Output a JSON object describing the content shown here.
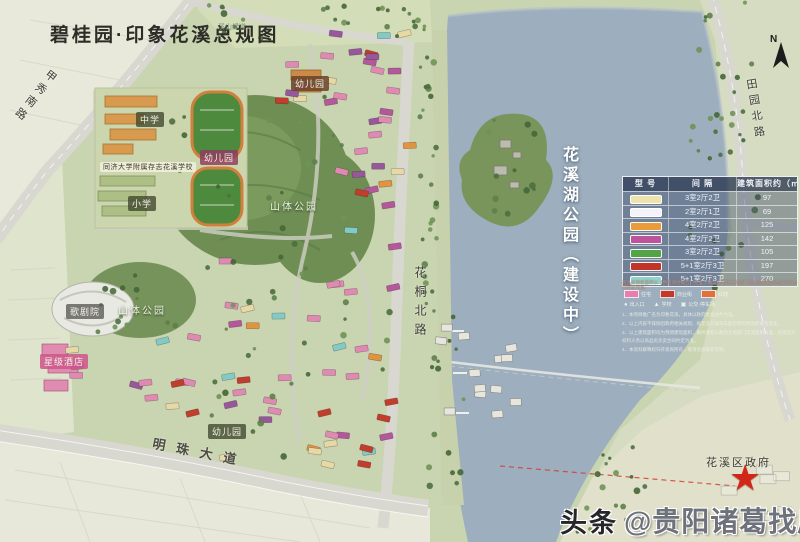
{
  "title": "碧桂园·印象花溪总规图",
  "north_label": "N",
  "map_labels": {
    "jiaxiu_road": "甲秀南路",
    "tianyuan_road": "田园北路",
    "huatong_road": "花桐北路",
    "mingzhu_road": "明珠大道",
    "greenway": "溪山绿道",
    "middle_school": "中学",
    "primary_school": "小学",
    "school_full": "同济大学附属存志花溪学校",
    "kindergarten_top": "幼儿园",
    "kindergarten_mid": "幼儿园",
    "kindergarten_bottom": "幼儿园",
    "mountain_park_main": "山体公园",
    "mountain_park_west": "山体公园",
    "opera_house": "歌剧院",
    "star_hotel": "星级酒店",
    "lake_park": "花溪湖公园（建设中）",
    "district_government": "花溪区政府"
  },
  "legend": {
    "headers": [
      "型 号",
      "间 隔",
      "建筑面积约（㎡）"
    ],
    "rows": [
      {
        "color": "#eee3ac",
        "layout": "3室2厅2卫",
        "area": "97"
      },
      {
        "color": "#f3f3f9",
        "layout": "2室2厅1卫",
        "area": "69"
      },
      {
        "color": "#ea9c3b",
        "layout": "4室2厅2卫",
        "area": "125"
      },
      {
        "color": "#bd539b",
        "layout": "4室2厅2卫",
        "area": "142"
      },
      {
        "color": "#54a447",
        "layout": "3室2厅2卫",
        "area": "105"
      },
      {
        "color": "#c03527",
        "layout": "5+1室2厅3卫",
        "area": "197"
      },
      {
        "color": "#8fd3cd",
        "layout": "5+1室2厅3卫",
        "area": "270"
      }
    ],
    "note": "商品房预售面积以【预售测绘报告】为准，确认以行政主管部门测绘结果和商品房买卖合同约定为准。",
    "mini_chips": [
      {
        "color": "#e77fae",
        "label": "住宅"
      },
      {
        "color": "#c13a28",
        "label": "商业街"
      },
      {
        "color": "#e0703c",
        "label": "红线"
      }
    ],
    "mini_icons": [
      {
        "glyph": "●",
        "label": "出入口"
      },
      {
        "glyph": "▲",
        "label": "学校"
      },
      {
        "glyph": "▣",
        "label": "公交·停车场"
      }
    ],
    "disclaimers": [
      "1、本项目推广名为印象花溪，具体以政府批准文件为准。",
      "2、以上内容不排除因政府相关规划、规定及开发商未能控制的原因而发生变化。",
      "3、以上建筑面积均为预测建筑面积，最终面积以政府主管部门实测面积为准，买卖双方权利义务以商品房买卖合同约定为准。",
      "4、本资料解释权归开发商所有，敬请留意最新资料。"
    ]
  },
  "watermark": {
    "logo": "头条",
    "handle": "@贵阳诸葛找房网"
  }
}
